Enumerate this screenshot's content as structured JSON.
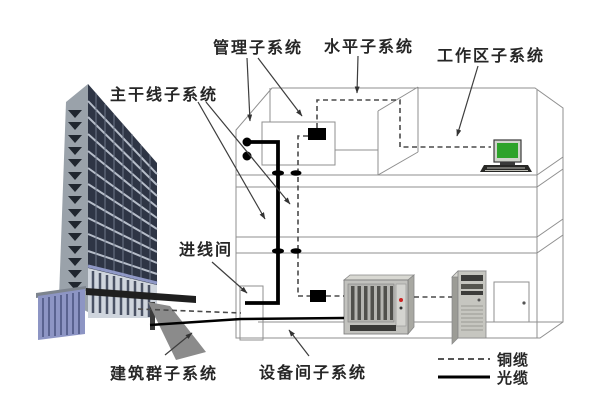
{
  "diagram": {
    "labels": {
      "management": "管理子系统",
      "horizontal": "水平子系统",
      "work_area": "工作区子系统",
      "backbone": "主干线子系统",
      "entrance_room": "进线间",
      "campus": "建筑群子系统",
      "equipment_room": "设备间子系统"
    },
    "legend": {
      "copper": "铜缆",
      "fiber": "光缆",
      "copper_style": "dashed",
      "fiber_style": "solid"
    },
    "colors": {
      "structure_line": "#8f8f8f",
      "copper_cable": "#4a4a4a",
      "fiber_cable": "#000000",
      "label_text": "#262626",
      "screen_green": "#2da32a",
      "indicator_red": "#cc2222",
      "building_window": "#2e3545",
      "building_frame": "#b6bdc9"
    }
  }
}
